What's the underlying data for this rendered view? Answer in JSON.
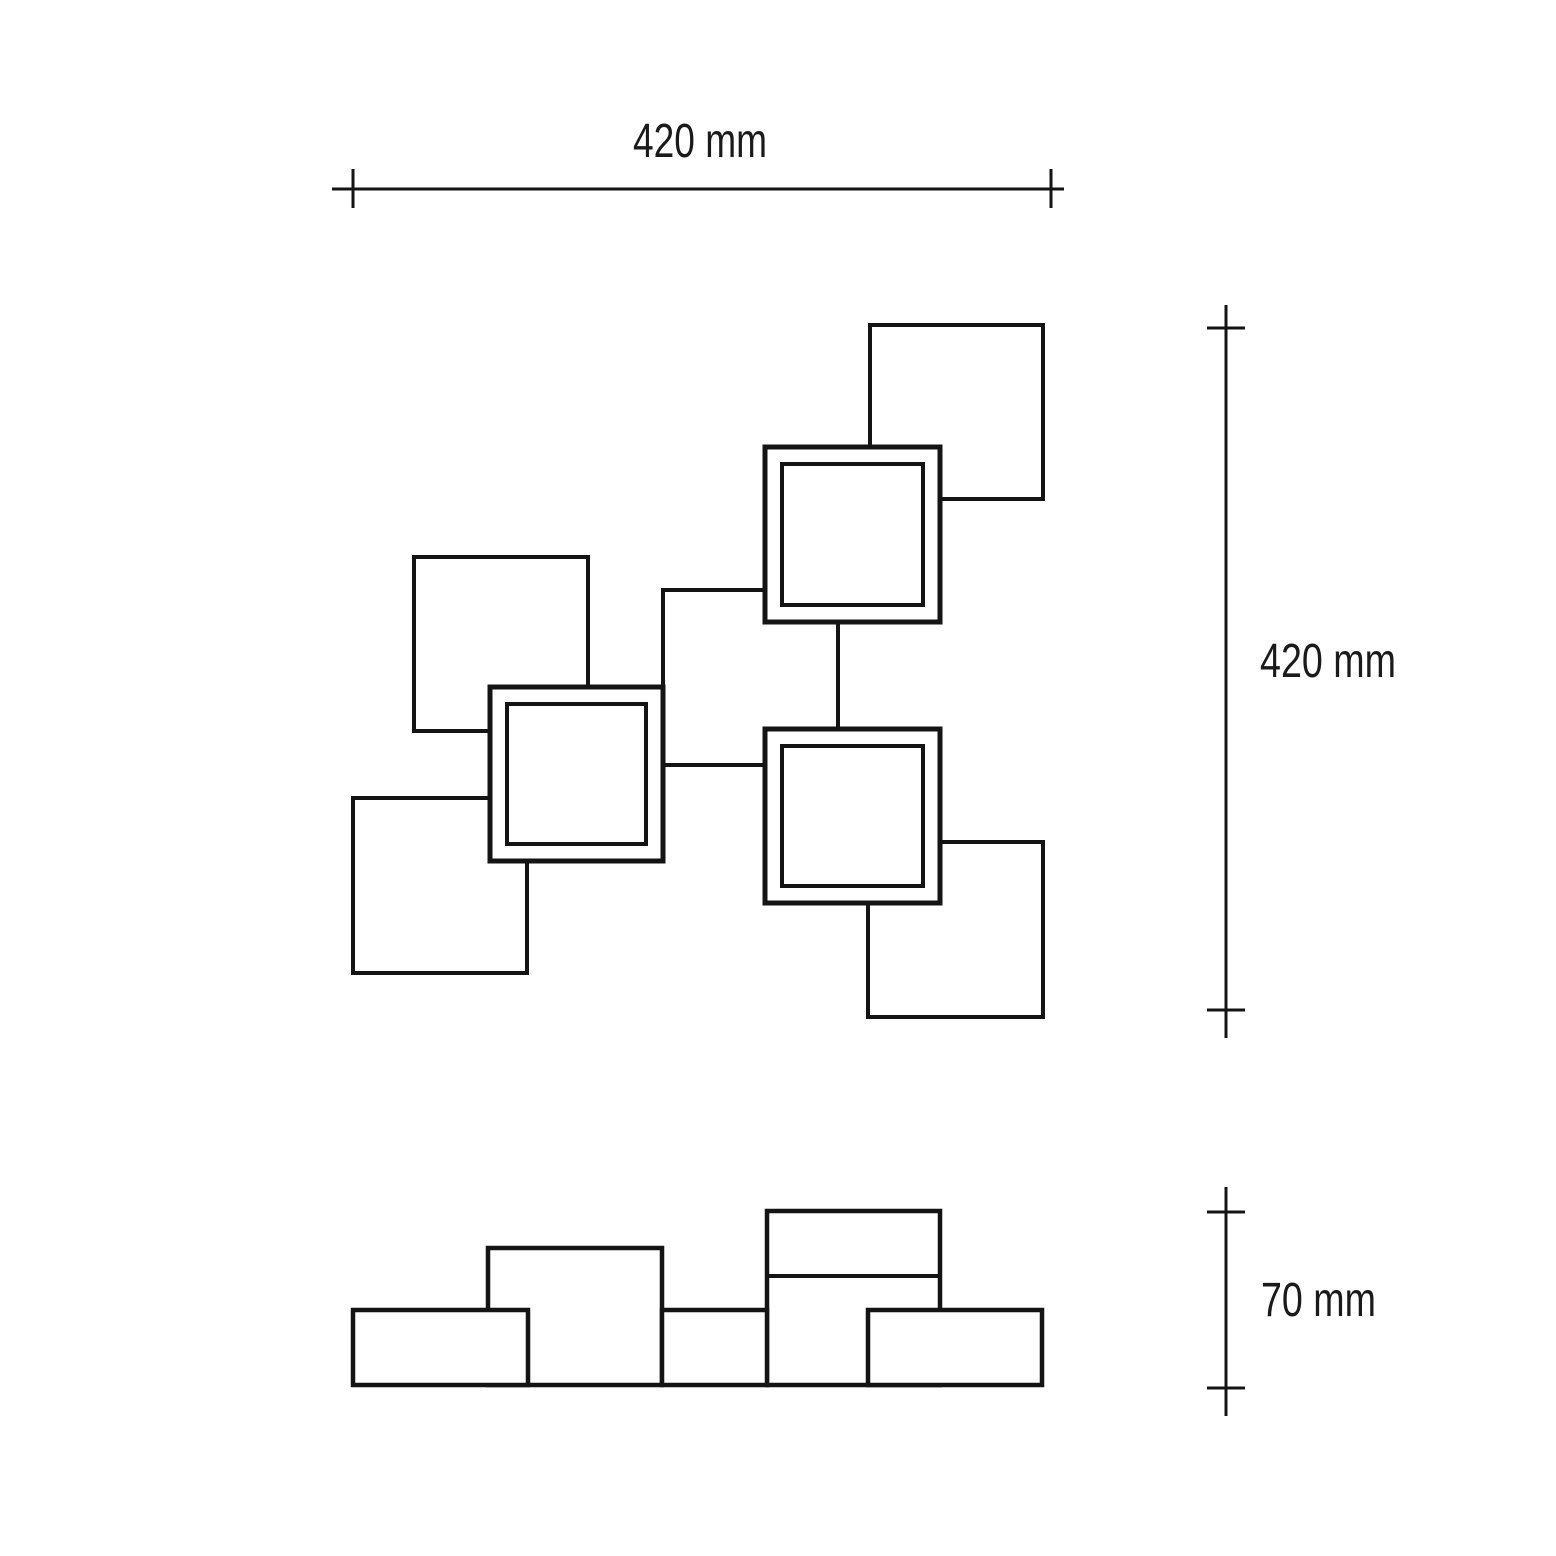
{
  "drawing": {
    "background": "#ffffff",
    "line_color": "#141414"
  },
  "dimensions": {
    "width": {
      "label": "420 mm"
    },
    "height": {
      "label": "420 mm"
    },
    "depth": {
      "label": "70 mm"
    }
  },
  "front_view": {
    "plain_squares": [
      {
        "name": "top-left-square",
        "x": 414,
        "y": 557,
        "w": 174,
        "h": 174
      },
      {
        "name": "bottom-left-square",
        "x": 353,
        "y": 798,
        "w": 174,
        "h": 175
      },
      {
        "name": "top-right-square",
        "x": 870,
        "y": 325,
        "w": 173,
        "h": 174
      },
      {
        "name": "bottom-right-square",
        "x": 868,
        "y": 842,
        "w": 175,
        "h": 175
      },
      {
        "name": "center-square",
        "x": 663,
        "y": 590,
        "w": 175,
        "h": 175
      }
    ],
    "framed_squares": [
      {
        "name": "light-square-top",
        "x": 765,
        "y": 447,
        "w": 175,
        "h": 175,
        "inset": 17
      },
      {
        "name": "light-square-left",
        "x": 490,
        "y": 687,
        "w": 173,
        "h": 174,
        "inset": 17
      },
      {
        "name": "light-square-right",
        "x": 765,
        "y": 729,
        "w": 175,
        "h": 174,
        "inset": 17
      }
    ]
  },
  "side_view": {
    "blocks": [
      {
        "name": "center-tall-block",
        "x": 488,
        "y": 1248,
        "w": 174,
        "h": 137
      },
      {
        "name": "right-tall-block",
        "x": 767,
        "y": 1211,
        "w": 173,
        "h": 174,
        "divider_y": 1276
      },
      {
        "name": "left-low-block",
        "x": 353,
        "y": 1310,
        "w": 175,
        "h": 75
      },
      {
        "name": "middle-low-block",
        "x": 662,
        "y": 1310,
        "w": 105,
        "h": 75
      },
      {
        "name": "right-low-block",
        "x": 868,
        "y": 1310,
        "w": 174,
        "h": 75
      }
    ]
  },
  "dimension_lines": {
    "top": {
      "line": {
        "x1": 332,
        "y1": 189,
        "x2": 1064,
        "y2": 189
      },
      "ticks": [
        {
          "x1": 353,
          "y1": 169,
          "x2": 353,
          "y2": 208
        },
        {
          "x1": 1051,
          "y1": 169,
          "x2": 1051,
          "y2": 208
        }
      ]
    },
    "right": {
      "line": {
        "x1": 1226,
        "y1": 305,
        "x2": 1226,
        "y2": 1038
      },
      "ticks": [
        {
          "x1": 1207,
          "y1": 328,
          "x2": 1245,
          "y2": 328
        },
        {
          "x1": 1207,
          "y1": 1010,
          "x2": 1245,
          "y2": 1010
        }
      ]
    },
    "depth": {
      "line": {
        "x1": 1226,
        "y1": 1187,
        "x2": 1226,
        "y2": 1416
      },
      "ticks": [
        {
          "x1": 1207,
          "y1": 1212,
          "x2": 1245,
          "y2": 1212
        },
        {
          "x1": 1207,
          "y1": 1388,
          "x2": 1245,
          "y2": 1388
        }
      ]
    }
  }
}
